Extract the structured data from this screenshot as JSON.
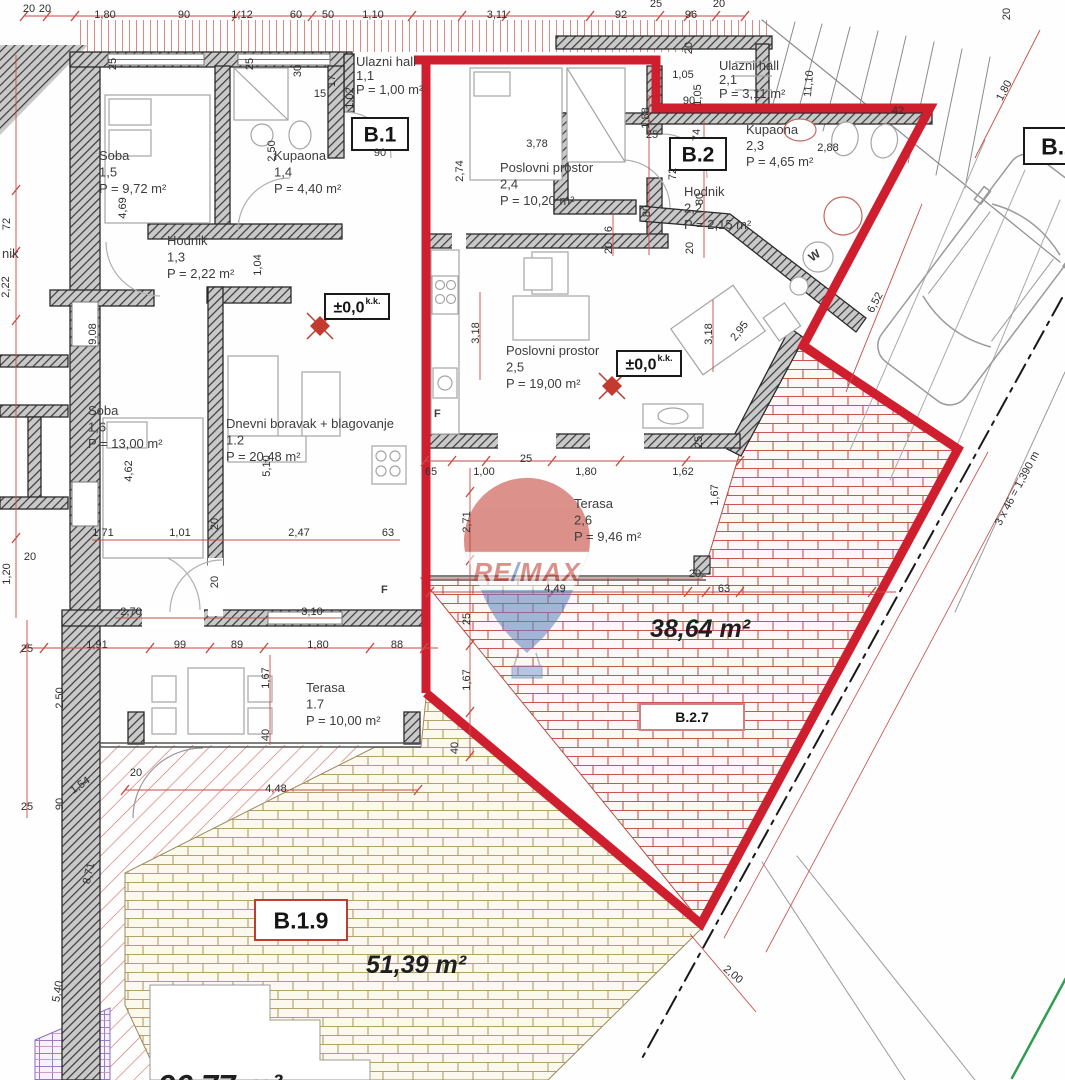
{
  "watermark": {
    "re": "RE",
    "slash": "/",
    "max": "MAX"
  },
  "rooms": [
    {
      "name": "Soba",
      "num": "1,5",
      "area": "P = 9,72 m²",
      "x": 99,
      "y": 160
    },
    {
      "name": "Kupaona",
      "num": "1,4",
      "area": "P = 4,40 m²",
      "x": 274,
      "y": 160
    },
    {
      "name": "Hodnik",
      "num": "1,3",
      "area": "P = 2,22 m²",
      "x": 167,
      "y": 245
    },
    {
      "name": "Ulazni hall",
      "num": "1,1",
      "area": "P = 1,00 m²",
      "x": 356,
      "y": 66,
      "fs": 12,
      "lh": 14
    },
    {
      "name": "Soba",
      "num": "1,6",
      "area": "P = 13,00 m²",
      "x": 88,
      "y": 415
    },
    {
      "name": "Dnevni boravak + blagovanje",
      "num": "1.2",
      "area": "P = 20,48 m²",
      "x": 226,
      "y": 428
    },
    {
      "name": "Terasa",
      "num": "1.7",
      "area": "P = 10,00 m²",
      "x": 306,
      "y": 692
    },
    {
      "name": "Ulazni hall",
      "num": "2,1",
      "area": "P = 3,11 m²",
      "x": 719,
      "y": 70,
      "fs": 12,
      "lh": 14
    },
    {
      "name": "Poslovni prostor",
      "num": "2,4",
      "area": "P = 10,20 m²",
      "x": 500,
      "y": 172
    },
    {
      "name": "Kupaona",
      "num": "2,3",
      "area": "P = 4,65 m²",
      "x": 746,
      "y": 134,
      "fs": 12,
      "lh": 16
    },
    {
      "name": "Hodnik",
      "num": "2,2",
      "area": "P = 2,15 m²",
      "x": 684,
      "y": 196
    },
    {
      "name": "Poslovni prostor",
      "num": "2,5",
      "area": "P = 19,00 m²",
      "x": 506,
      "y": 355
    },
    {
      "name": "Terasa",
      "num": "2,6",
      "area": "P = 9,46 m²",
      "x": 574,
      "y": 508
    }
  ],
  "badges": [
    {
      "label": "B.1",
      "x": 352,
      "y": 118,
      "w": 56,
      "h": 32,
      "fs": 21,
      "border": "#1a1a1a"
    },
    {
      "label": "B.2",
      "x": 670,
      "y": 138,
      "w": 56,
      "h": 32,
      "fs": 21,
      "border": "#1a1a1a"
    },
    {
      "label": "B.2",
      "x": 1024,
      "y": 128,
      "w": 70,
      "h": 36,
      "fs": 23,
      "border": "#1a1a1a"
    },
    {
      "label": "B.2.7",
      "x": 640,
      "y": 704,
      "w": 104,
      "h": 26,
      "fs": 14,
      "border": "#d08080"
    },
    {
      "label": "B.1.9",
      "x": 255,
      "y": 900,
      "w": 92,
      "h": 40,
      "fs": 23,
      "border": "#c23b33"
    },
    {
      "label": "±0,0",
      "sup": "k.k.",
      "x": 325,
      "y": 294,
      "w": 64,
      "h": 25,
      "fs": 16,
      "border": "#1a1a1a"
    },
    {
      "label": "±0,0",
      "sup": "k.k.",
      "x": 617,
      "y": 351,
      "w": 64,
      "h": 25,
      "fs": 16,
      "border": "#1a1a1a"
    }
  ],
  "area_labels": [
    {
      "t": "38,64 m²",
      "x": 700,
      "y": 637,
      "fs": 25
    },
    {
      "t": "51,39 m²",
      "x": 416,
      "y": 973,
      "fs": 25
    },
    {
      "t": "96,77 m²",
      "x": 220,
      "y": 1096,
      "fs": 31
    }
  ],
  "misc_labels": [
    {
      "t": "nik",
      "x": 2,
      "y": 258,
      "fs": 13
    },
    {
      "t": "F",
      "x": 434,
      "y": 417,
      "fs": 11,
      "bold": true
    },
    {
      "t": "F",
      "x": 381,
      "y": 593,
      "fs": 11,
      "bold": true
    },
    {
      "t": "W",
      "x": 812,
      "y": 262,
      "fs": 12,
      "r": -35,
      "bold": true
    }
  ],
  "dimensions": [
    {
      "t": "20",
      "x": 29,
      "y": 12
    },
    {
      "t": "20",
      "x": 45,
      "y": 12
    },
    {
      "t": "1,80",
      "x": 105,
      "y": 18
    },
    {
      "t": "90",
      "x": 184,
      "y": 18
    },
    {
      "t": "1,12",
      "x": 242,
      "y": 18
    },
    {
      "t": "60",
      "x": 296,
      "y": 18
    },
    {
      "t": "50",
      "x": 328,
      "y": 18
    },
    {
      "t": "1,10",
      "x": 373,
      "y": 18
    },
    {
      "t": "3,11",
      "x": 497,
      "y": 18
    },
    {
      "t": "92",
      "x": 621,
      "y": 18
    },
    {
      "t": "96",
      "x": 691,
      "y": 18
    },
    {
      "t": "25",
      "x": 656,
      "y": 7
    },
    {
      "t": "20",
      "x": 719,
      "y": 7
    },
    {
      "t": "20",
      "x": 1010,
      "y": 14,
      "r": -90
    },
    {
      "t": "72",
      "x": 10,
      "y": 224,
      "r": -90
    },
    {
      "t": "2,22",
      "x": 9,
      "y": 287,
      "r": -90
    },
    {
      "t": "1,20",
      "x": 10,
      "y": 574,
      "r": -90
    },
    {
      "t": "25",
      "x": 27,
      "y": 652
    },
    {
      "t": "2,50",
      "x": 63,
      "y": 698,
      "r": -90
    },
    {
      "t": "25",
      "x": 27,
      "y": 810
    },
    {
      "t": "90",
      "x": 63,
      "y": 804,
      "r": -90
    },
    {
      "t": "1,54",
      "x": 82,
      "y": 788,
      "r": -35
    },
    {
      "t": "8,71",
      "x": 92,
      "y": 874,
      "r": -78
    },
    {
      "t": "5,40",
      "x": 61,
      "y": 992,
      "r": -80
    },
    {
      "t": "25",
      "x": 116,
      "y": 64,
      "r": -90
    },
    {
      "t": "25",
      "x": 253,
      "y": 64,
      "r": -90
    },
    {
      "t": "30",
      "x": 301,
      "y": 71,
      "r": -90
    },
    {
      "t": "15",
      "x": 320,
      "y": 97
    },
    {
      "t": "17",
      "x": 335,
      "y": 81,
      "r": -90
    },
    {
      "t": "1,02",
      "x": 353,
      "y": 98,
      "r": -90
    },
    {
      "t": "90",
      "x": 380,
      "y": 156
    },
    {
      "t": "2,50",
      "x": 275,
      "y": 151,
      "r": -90
    },
    {
      "t": "1,04",
      "x": 261,
      "y": 265,
      "r": -90
    },
    {
      "t": "4,69",
      "x": 126,
      "y": 208,
      "r": -90
    },
    {
      "t": "9,08",
      "x": 96,
      "y": 334,
      "r": -90
    },
    {
      "t": "4,62",
      "x": 132,
      "y": 471,
      "r": -90
    },
    {
      "t": "5,10",
      "x": 270,
      "y": 466,
      "r": -90
    },
    {
      "t": "1,71",
      "x": 103,
      "y": 536
    },
    {
      "t": "1,01",
      "x": 180,
      "y": 536
    },
    {
      "t": "2,47",
      "x": 299,
      "y": 536
    },
    {
      "t": "63",
      "x": 388,
      "y": 536
    },
    {
      "t": "20",
      "x": 218,
      "y": 524,
      "r": -90
    },
    {
      "t": "20",
      "x": 218,
      "y": 582,
      "r": -90
    },
    {
      "t": "2,70",
      "x": 131,
      "y": 615
    },
    {
      "t": "3,10",
      "x": 312,
      "y": 615
    },
    {
      "t": "20",
      "x": 30,
      "y": 560
    },
    {
      "t": "1,91",
      "x": 97,
      "y": 648
    },
    {
      "t": "99",
      "x": 180,
      "y": 648
    },
    {
      "t": "89",
      "x": 237,
      "y": 648
    },
    {
      "t": "1,80",
      "x": 318,
      "y": 648
    },
    {
      "t": "88",
      "x": 397,
      "y": 648
    },
    {
      "t": "1,67",
      "x": 269,
      "y": 678,
      "r": -90
    },
    {
      "t": "40",
      "x": 269,
      "y": 735,
      "r": -90
    },
    {
      "t": "20",
      "x": 136,
      "y": 776
    },
    {
      "t": "4,48",
      "x": 276,
      "y": 792
    },
    {
      "t": "1,05",
      "x": 683,
      "y": 78
    },
    {
      "t": "1,05",
      "x": 701,
      "y": 95,
      "r": -90
    },
    {
      "t": "90",
      "x": 689,
      "y": 104
    },
    {
      "t": "11,10",
      "x": 812,
      "y": 84,
      "r": -85
    },
    {
      "t": "42",
      "x": 898,
      "y": 114
    },
    {
      "t": "20",
      "x": 692,
      "y": 48,
      "r": -90
    },
    {
      "t": "2,74",
      "x": 463,
      "y": 171,
      "r": -90
    },
    {
      "t": "3,78",
      "x": 537,
      "y": 147
    },
    {
      "t": "1,88",
      "x": 649,
      "y": 118,
      "r": -90
    },
    {
      "t": "25",
      "x": 652,
      "y": 138
    },
    {
      "t": "80",
      "x": 650,
      "y": 211,
      "r": -90
    },
    {
      "t": "6",
      "x": 612,
      "y": 229,
      "r": -90
    },
    {
      "t": "20",
      "x": 612,
      "y": 248,
      "r": -90
    },
    {
      "t": "74",
      "x": 700,
      "y": 135,
      "r": -90
    },
    {
      "t": "2,88",
      "x": 828,
      "y": 151
    },
    {
      "t": "72",
      "x": 676,
      "y": 174,
      "r": -90
    },
    {
      "t": "80",
      "x": 703,
      "y": 199,
      "r": -90
    },
    {
      "t": "20",
      "x": 693,
      "y": 248,
      "r": -90
    },
    {
      "t": "3,18",
      "x": 479,
      "y": 333,
      "r": -90
    },
    {
      "t": "3,18",
      "x": 712,
      "y": 334,
      "r": -90
    },
    {
      "t": "2,95",
      "x": 742,
      "y": 333,
      "r": -52
    },
    {
      "t": "25",
      "x": 526,
      "y": 462
    },
    {
      "t": "65",
      "x": 431,
      "y": 475
    },
    {
      "t": "1,00",
      "x": 484,
      "y": 475
    },
    {
      "t": "1,80",
      "x": 586,
      "y": 475
    },
    {
      "t": "1,62",
      "x": 683,
      "y": 475
    },
    {
      "t": "25",
      "x": 702,
      "y": 442,
      "r": -90
    },
    {
      "t": "1,67",
      "x": 718,
      "y": 495,
      "r": -90
    },
    {
      "t": "2,71",
      "x": 470,
      "y": 522,
      "r": -90
    },
    {
      "t": "25",
      "x": 470,
      "y": 619,
      "r": -90
    },
    {
      "t": "1,67",
      "x": 470,
      "y": 680,
      "r": -90
    },
    {
      "t": "40",
      "x": 458,
      "y": 748,
      "r": -90
    },
    {
      "t": "4,49",
      "x": 555,
      "y": 592
    },
    {
      "t": "20",
      "x": 695,
      "y": 577
    },
    {
      "t": "63",
      "x": 724,
      "y": 592
    },
    {
      "t": "6,52",
      "x": 878,
      "y": 304,
      "r": -62
    },
    {
      "t": "1,80",
      "x": 1007,
      "y": 92,
      "r": -62
    },
    {
      "t": "3 x 46 = 1,390 m",
      "x": 1020,
      "y": 490,
      "r": -62,
      "fs": 10
    },
    {
      "t": "2,00",
      "x": 731,
      "y": 977,
      "r": 40
    }
  ]
}
